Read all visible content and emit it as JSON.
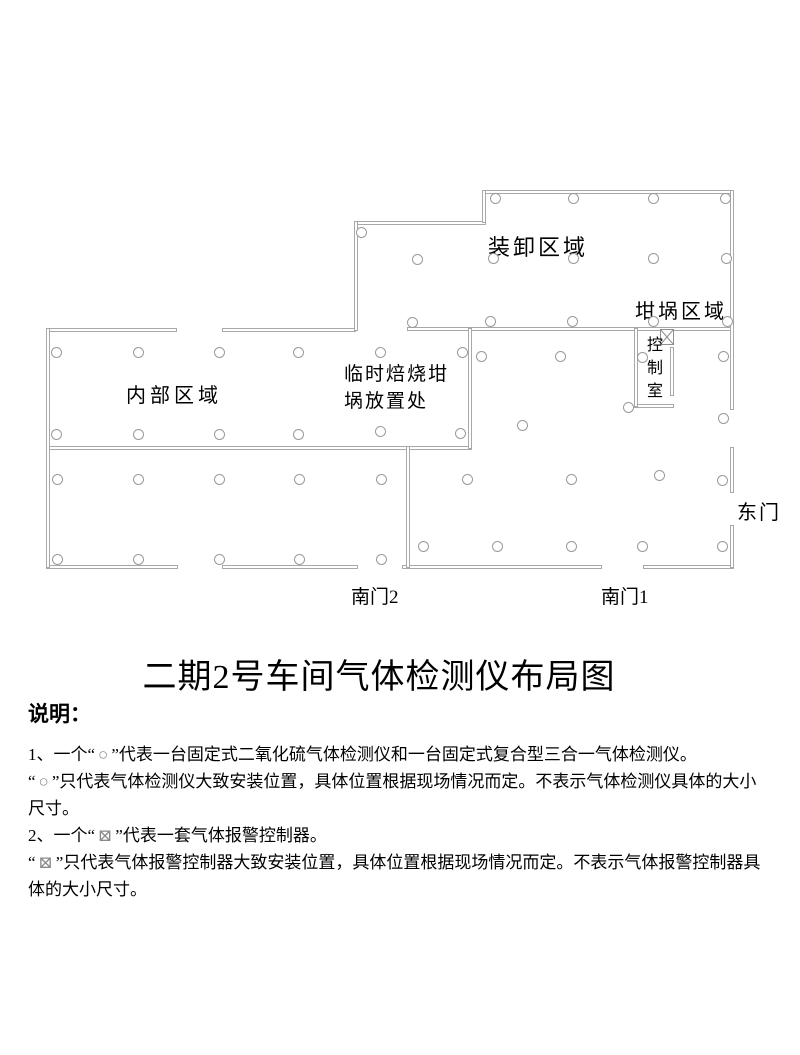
{
  "title": "二期2号车间气体检测仪布局图",
  "floor_plan": {
    "line_color": "#a8a8a8",
    "zones": {
      "loading": "装卸区域",
      "crucible": "坩埚区域",
      "internal": "内部区域",
      "temp_roasting": "临时焙烧坩埚放置处",
      "control_room": "控制室"
    },
    "doors": {
      "east": "东门",
      "south2": "南门2",
      "south1": "南门1"
    },
    "detector_symbol": "○",
    "controller_symbol": "⊠",
    "detectors": [
      [
        495,
        198
      ],
      [
        573,
        198
      ],
      [
        653,
        198
      ],
      [
        725,
        198
      ],
      [
        361,
        232
      ],
      [
        417,
        259
      ],
      [
        493,
        258
      ],
      [
        573,
        258
      ],
      [
        653,
        258
      ],
      [
        726,
        258
      ],
      [
        412,
        322
      ],
      [
        490,
        321
      ],
      [
        572,
        321
      ],
      [
        653,
        321
      ],
      [
        727,
        321
      ],
      [
        56,
        352
      ],
      [
        138,
        352
      ],
      [
        219,
        352
      ],
      [
        298,
        352
      ],
      [
        380,
        352
      ],
      [
        462,
        352
      ],
      [
        56,
        434
      ],
      [
        138,
        434
      ],
      [
        219,
        434
      ],
      [
        298,
        434
      ],
      [
        380,
        431
      ],
      [
        460,
        433
      ],
      [
        481,
        356
      ],
      [
        560,
        356
      ],
      [
        642,
        357
      ],
      [
        723,
        356
      ],
      [
        628,
        407
      ],
      [
        723,
        418
      ],
      [
        522,
        425
      ],
      [
        57,
        479
      ],
      [
        138,
        479
      ],
      [
        219,
        479
      ],
      [
        299,
        479
      ],
      [
        381,
        479
      ],
      [
        57,
        559
      ],
      [
        138,
        559
      ],
      [
        219,
        559
      ],
      [
        299,
        559
      ],
      [
        381,
        559
      ],
      [
        467,
        479
      ],
      [
        571,
        479
      ],
      [
        659,
        475
      ],
      [
        722,
        480
      ],
      [
        423,
        546
      ],
      [
        497,
        546
      ],
      [
        571,
        546
      ],
      [
        642,
        546
      ],
      [
        722,
        546
      ]
    ],
    "controller": {
      "x": 660,
      "y": 329
    }
  },
  "notes": {
    "heading": "说明：",
    "items": [
      {
        "pre": "1、一个“",
        "sym": "○",
        "post": "”代表一台固定式二氧化硫气体检测仪和一台固定式复合型三合一气体检测仪。"
      },
      {
        "pre": "“",
        "sym": "○",
        "post": "”只代表气体检测仪大致安装位置，具体位置根据现场情况而定。不表示气体检测仪具体的大小尺寸。"
      },
      {
        "pre": "2、一个“",
        "sym": "⊠",
        "post": "”代表一套气体报警控制器。"
      },
      {
        "pre": "“",
        "sym": "⊠",
        "post": "”只代表气体报警控制器大致安装位置，具体位置根据现场情况而定。不表示气体报警控制器具体的大小尺寸。"
      }
    ]
  }
}
